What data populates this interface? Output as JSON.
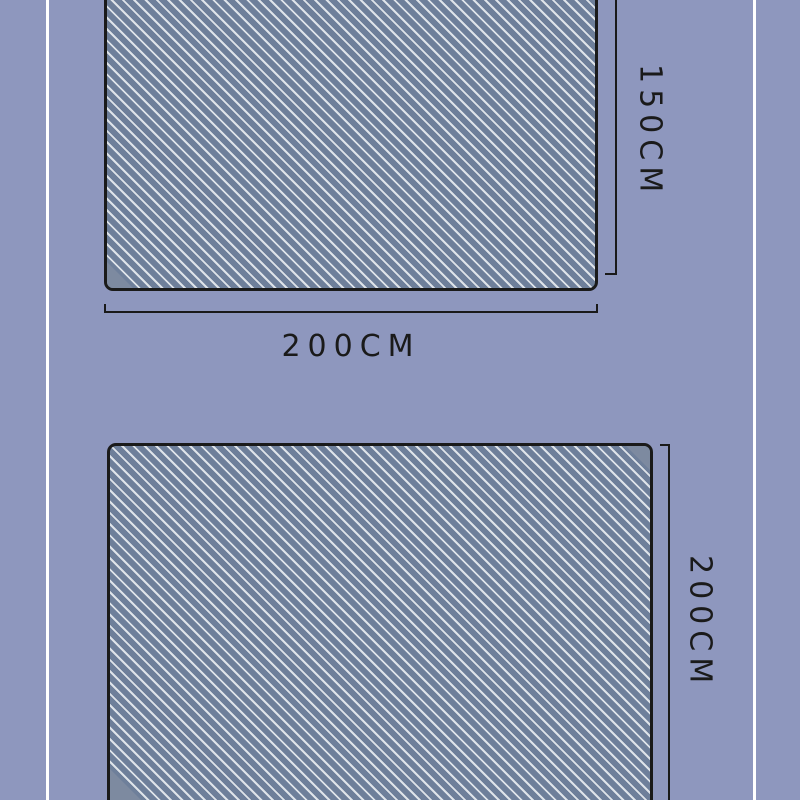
{
  "colors": {
    "page-bg": "#8E97BE",
    "divider": "#FFFFFF",
    "blanket-dark": "#6E7F9A",
    "stripe-light": "#DEE3E9",
    "fold": "#7D8AA0",
    "line": "#1A1A1A",
    "text": "#1A1A1A"
  },
  "diagram_top": {
    "width_label": "200CM",
    "height_label": "150CM"
  },
  "diagram_bottom": {
    "height_label": "200CM"
  }
}
